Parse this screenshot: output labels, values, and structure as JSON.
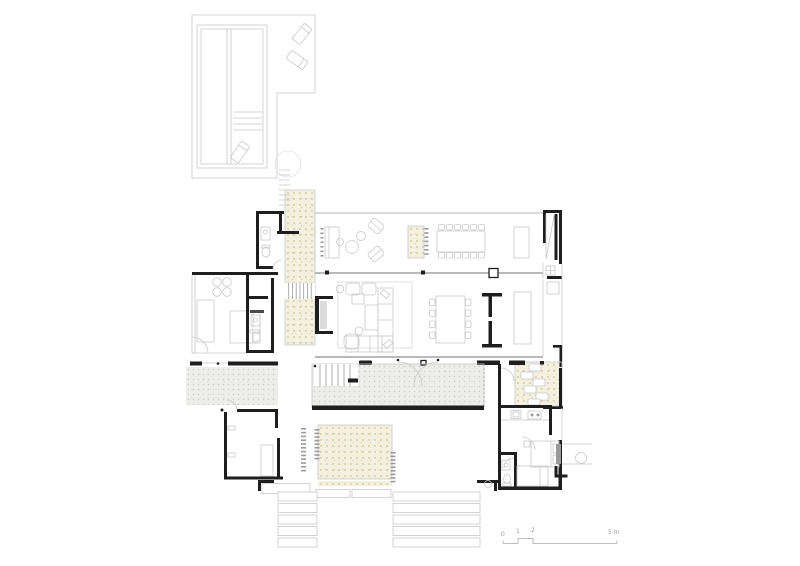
{
  "scale_bar": {
    "labels": [
      "0",
      "1",
      "2",
      "5 m"
    ]
  },
  "colors": {
    "background": "#ffffff",
    "wall": "#1e1e1e",
    "light_line": "#c9c9c9",
    "mid_line": "#9b9b9b",
    "glass_line": "#8f8f8f",
    "gravel_fill": "#f4f0e0",
    "gravel_dot": "#d6cba2",
    "terrace_fill": "#ededeb",
    "terrace_dot": "#cfcfc9",
    "label": "#999999"
  }
}
